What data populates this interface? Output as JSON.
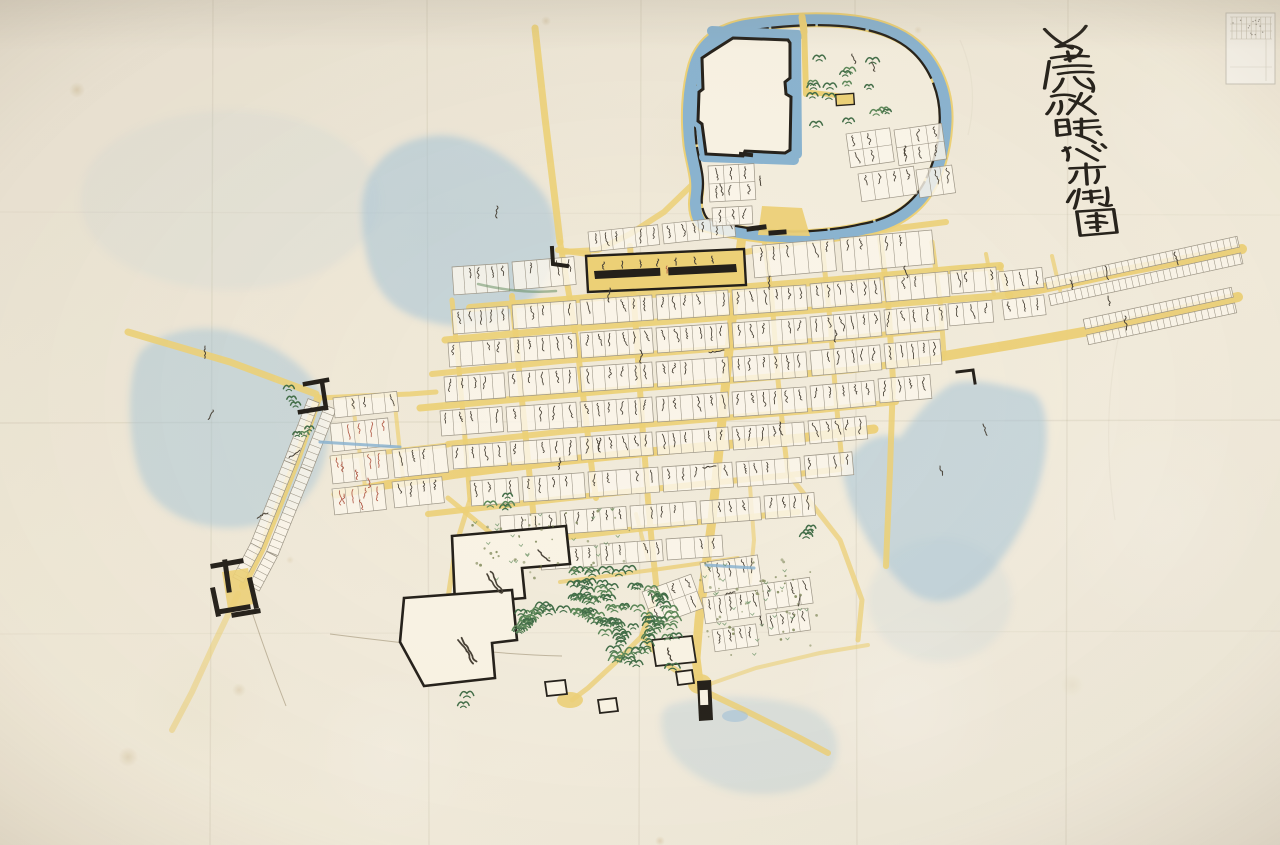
{
  "image_type": "photograph of a hand-painted Edo-period Japanese castle-town map on creased paper",
  "title": {
    "text": "舊藩政時代市街圖",
    "style": "vertical brush calligraphy, upper right corner",
    "legibility": "cursive grass-script; reading uncertain"
  },
  "catalog_label": {
    "text": "",
    "description": "small archival sticker with printed grid and tiny handwritten entries, illegible",
    "position": "top-right corner"
  },
  "map_features": {
    "castle": "fan-shaped moated castle compound at top centre",
    "honmaru": "white inner bailey outlined with thick black wall lines",
    "moat_water": "blue watercolour moat band with yellow embankment rim",
    "roads": "yellow streets forming a tilted grid with diagonal arterials",
    "parcels": "hundreds of small lots bearing tiny vertical cursive ink inscriptions (illegible)",
    "long_black_row": "long black-outlined row building inline with the upper street",
    "temple_grove": "tree-covered temple precinct at bottom centre with black-outlined compounds",
    "water_bodies": "pale blue washes: lake upper-left, marsh left, large pond right, faint pond bottom",
    "gates": "black masugata (square gate) symbols on the south-west road and at the south exit",
    "fields": "dotted paddy / orchard areas",
    "red_marks": "occasional red-ink annotations in western blocks"
  },
  "colors": {
    "paper": "#ebe3d1",
    "paper_light": "#f6f0e1",
    "parcel": "#fbf7eb",
    "parcel_line": "#9a9384",
    "road": "#ecd075",
    "road_pale": "#f1e0a4",
    "water": "#9dc0d8",
    "moat": "#88b2cf",
    "ink": "#211d17",
    "text_ink": "#453e33",
    "red_ink": "#b05844",
    "tree_dark": "#3f6b45",
    "tree_mid": "#5a8656",
    "slope": "#94896f",
    "stain": "#b6985f"
  }
}
